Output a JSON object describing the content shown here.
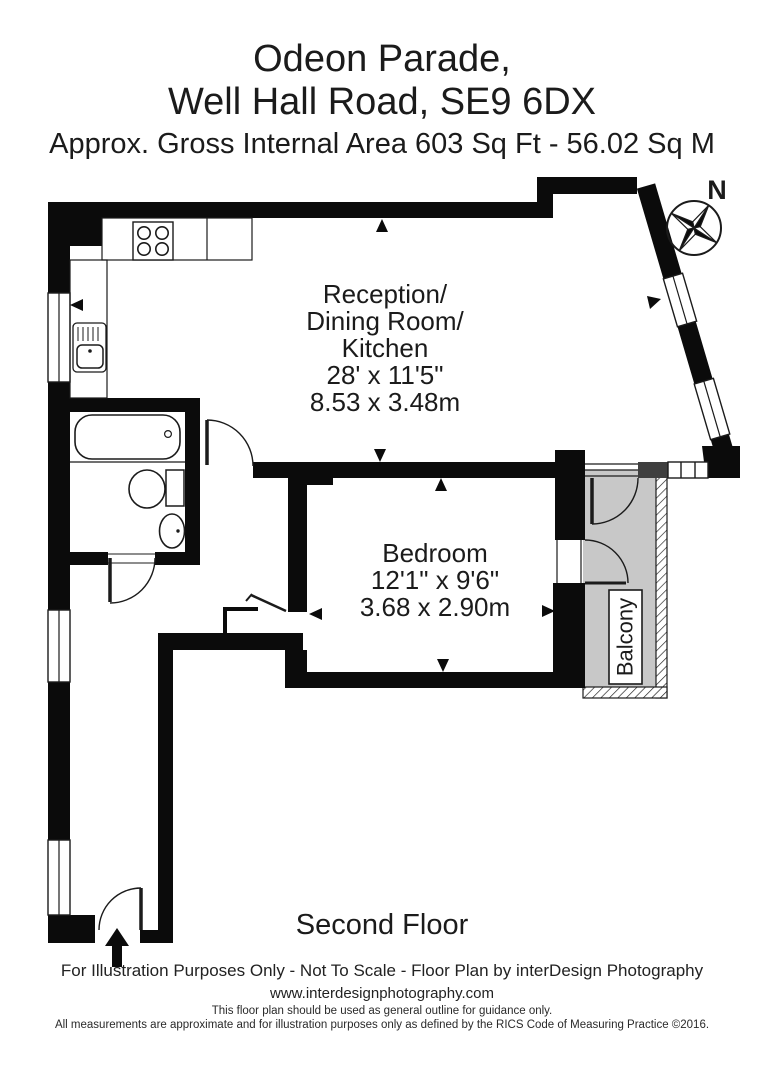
{
  "header": {
    "title_line1": "Odeon Parade,",
    "title_line2": "Well Hall Road, SE9 6DX",
    "area_line": "Approx. Gross Internal Area   603 Sq Ft  -  56.02 Sq M"
  },
  "compass": {
    "north_label": "N"
  },
  "rooms": {
    "reception": {
      "name_line1": "Reception/",
      "name_line2": "Dining Room/",
      "name_line3": "Kitchen",
      "dim_imperial": "28' x 11'5\"",
      "dim_metric": "8.53 x 3.48m"
    },
    "bedroom": {
      "name": "Bedroom",
      "dim_imperial": "12'1\" x 9'6\"",
      "dim_metric": "3.68 x 2.90m"
    },
    "balcony": {
      "name": "Balcony"
    }
  },
  "floor_label": "Second Floor",
  "footer": {
    "line1": "For Illustration Purposes Only - Not To Scale - Floor Plan by interDesign Photography",
    "website": "www.interdesignphotography.com",
    "fine_print1": "This floor plan should be used as general outline for guidance only.",
    "fine_print2": "All measurements are approximate and for illustration purposes only as defined by the RICS Code of Measuring Practice ©2016."
  },
  "colors": {
    "wall": "#0b0b0b",
    "balcony_fill": "#c8c8c8",
    "accent_block": "#3f3f3f"
  }
}
